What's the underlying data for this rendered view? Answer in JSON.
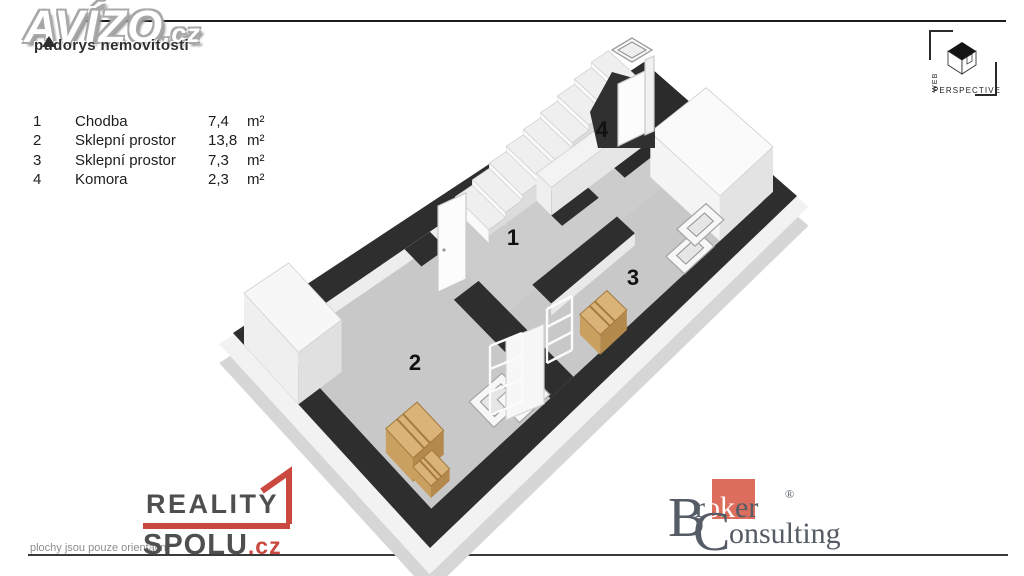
{
  "header": {
    "brand": "AVÍZO",
    "brand_tld": ".cz",
    "subtitle": "půdorys nemovitosti"
  },
  "legend": {
    "rows": [
      {
        "num": "1",
        "name": "Chodba",
        "area": "7,4",
        "unit": "m²"
      },
      {
        "num": "2",
        "name": "Sklepní prostor",
        "area": "13,8",
        "unit": "m²"
      },
      {
        "num": "3",
        "name": "Sklepní prostor",
        "area": "7,3",
        "unit": "m²"
      },
      {
        "num": "4",
        "name": "Komora",
        "area": "2,3",
        "unit": "m²"
      }
    ]
  },
  "watermarks": {
    "web_perspective": {
      "word1": "WEB",
      "word2": "PERSPECTIVE"
    },
    "reality_spolu": {
      "word1": "REALITY",
      "word2": "SPOLU",
      "tld": ".cz",
      "note": "plochy jsou pouze orientační",
      "accent": "#c9483f",
      "text": "#4f4f4f"
    },
    "broker": {
      "cap1": "B",
      "rest1_pre": "r",
      "rest1_mid": "ok",
      "rest1_post": "er",
      "reg": "®",
      "cap2": "C",
      "rest2": "onsulting",
      "accent": "#dd6e5e",
      "text": "#555c66"
    }
  },
  "plan": {
    "uv": [
      880,
      500
    ],
    "corners": {
      "A": [
        233,
        333
      ],
      "N": [
        644,
        62
      ],
      "S": [
        430,
        548
      ],
      "E": [
        797,
        196
      ]
    },
    "wall_color": "#2e2e2e",
    "floor_color": "#c8c8c8",
    "elements": [
      {
        "t": "quad",
        "r": [
          -16,
          -16,
          896,
          516
        ],
        "dy": 32,
        "fill": "#d6d6d6",
        "name": "base-slab-side"
      },
      {
        "t": "quad",
        "r": [
          -16,
          -16,
          896,
          516
        ],
        "dy": 13,
        "fill": "#f2f2f2",
        "name": "base-slab-top"
      },
      {
        "t": "rect",
        "r": [
          48,
          48,
          832,
          452
        ],
        "dy": 6,
        "fill": "#c8c8c8",
        "name": "floor"
      },
      {
        "t": "rect",
        "r": [
          385,
          48,
          832,
          260
        ],
        "dy": 6,
        "fill": "#cccccc",
        "name": "floor-room-1"
      },
      {
        "t": "strip",
        "e": [
          [
            48,
            48
          ],
          [
            832,
            48
          ]
        ],
        "dy": 16,
        "fill": "#ededed",
        "name": "wall-inner-face"
      },
      {
        "t": "strip",
        "e": [
          [
            832,
            48
          ],
          [
            832,
            452
          ]
        ],
        "dy": 16,
        "fill": "#f6f6f6",
        "name": "wall-inner-face"
      },
      {
        "t": "strip",
        "e": [
          [
            48,
            48
          ],
          [
            48,
            452
          ]
        ],
        "dy": 14,
        "fill": "#f1f1f1",
        "name": "wall-inner-face"
      },
      {
        "t": "strip",
        "e": [
          [
            385,
            185
          ],
          [
            385,
            455
          ]
        ],
        "dy": 12,
        "fill": "#e9e9e9",
        "name": "wall-inner-face"
      },
      {
        "t": "strip",
        "e": [
          [
            448,
            312
          ],
          [
            640,
            312
          ]
        ],
        "dy": 12,
        "fill": "#e9e9e9",
        "name": "wall-inner-face"
      },
      {
        "t": "ring",
        "outer": [
          0,
          0,
          880,
          500
        ],
        "inner": [
          48,
          48,
          832,
          452
        ],
        "fill": "#2e2e2e",
        "name": "outer-walls"
      },
      {
        "t": "rect",
        "r": [
          330,
          185,
          385,
          452
        ],
        "fill": "#2e2e2e",
        "name": "wall"
      },
      {
        "t": "rect",
        "r": [
          330,
          48,
          385,
          95
        ],
        "fill": "#2e2e2e",
        "name": "wall"
      },
      {
        "t": "rect",
        "r": [
          448,
          258,
          640,
          312
        ],
        "fill": "#2e2e2e",
        "name": "wall"
      },
      {
        "t": "rect",
        "r": [
          560,
          120,
          642,
          200
        ],
        "fill": "#2e2e2e",
        "name": "wall"
      },
      {
        "t": "rect",
        "r": [
          700,
          28,
          880,
          200
        ],
        "fill": "#2b2b2b",
        "name": "room-4-floor"
      },
      {
        "t": "block",
        "r": [
          732,
          235,
          858,
          452
        ],
        "h": 45,
        "w": "#f4f4f4",
        "s": "#e3e3e3",
        "top": "#fafafa",
        "name": "chimney-block"
      },
      {
        "t": "window",
        "r": [
          648,
          396,
          718,
          452
        ],
        "name": "window-frame"
      },
      {
        "t": "window",
        "r": [
          696,
          366,
          764,
          422
        ],
        "name": "window-frame"
      },
      {
        "t": "window",
        "r": [
          224,
          354,
          300,
          420
        ],
        "name": "window-frame"
      },
      {
        "t": "window",
        "r": [
          262,
          386,
          334,
          446
        ],
        "name": "window-frame"
      },
      {
        "t": "block",
        "r": [
          0,
          28,
          96,
          166
        ],
        "h": 52,
        "w": "#efefef",
        "s": "#e0e0e0",
        "top": "#f7f7f7",
        "name": "chimney-block"
      },
      {
        "t": "stairs",
        "u0": 455,
        "u1": 785,
        "v0": 28,
        "v1": 124,
        "n": 9,
        "rise": 5.3,
        "name": "staircase"
      },
      {
        "t": "block",
        "r": [
          560,
          124,
          785,
          168
        ],
        "h": 28,
        "w": "#efefef",
        "s": "#e6e6e6",
        "top": "#f3f3f3",
        "name": "stair-side-wall"
      },
      {
        "t": "crate",
        "r": [
          445,
          398,
          508,
          456
        ],
        "h": 20,
        "name": "wooden-crate"
      },
      {
        "t": "crate",
        "r": [
          56,
          326,
          128,
          396
        ],
        "h": 24,
        "name": "wooden-crate"
      },
      {
        "t": "crate",
        "r": [
          60,
          392,
          104,
          438
        ],
        "h": 12,
        "name": "wooden-crate"
      }
    ],
    "screen_shapes": [
      {
        "t": "poly",
        "pts": [
          [
            590,
            112
          ],
          [
            612,
            72
          ],
          [
            655,
            84
          ],
          [
            655,
            148
          ],
          [
            598,
            148
          ]
        ],
        "fill": "#303030",
        "name": "room-4-shadow"
      },
      {
        "t": "poly",
        "pts": [
          [
            506,
            420
          ],
          [
            506,
            340
          ],
          [
            544,
            324
          ],
          [
            544,
            404
          ]
        ],
        "fill": "#f7f7f7",
        "stroke": "#d2d2d2",
        "name": "leaning-panel"
      },
      {
        "t": "rack",
        "x": 489,
        "y": 333,
        "w": 34,
        "h": 82,
        "name": "shelf-rack"
      },
      {
        "t": "rack",
        "x": 546,
        "y": 296,
        "w": 27,
        "h": 67,
        "name": "shelf-rack"
      },
      {
        "t": "poly",
        "pts": [
          [
            438,
            292
          ],
          [
            438,
            206
          ],
          [
            466,
            193
          ],
          [
            466,
            279
          ]
        ],
        "fill": "#fcfcfc",
        "stroke": "#c9c9c9",
        "name": "door-leaf"
      },
      {
        "t": "dot",
        "x": 444,
        "y": 250,
        "name": "door-handle"
      },
      {
        "t": "poly",
        "pts": [
          [
            618,
            146
          ],
          [
            618,
            84
          ],
          [
            645,
            71
          ],
          [
            645,
            133
          ]
        ],
        "fill": "#fcfcfc",
        "stroke": "#c9c9c9",
        "name": "door-leaf"
      },
      {
        "t": "poly",
        "pts": [
          [
            645,
            135
          ],
          [
            645,
            60
          ],
          [
            654,
            56
          ],
          [
            654,
            131
          ]
        ],
        "fill": "#f1f1f1",
        "stroke": "#cccccc",
        "name": "door-post"
      },
      {
        "t": "frame",
        "o": [
          [
            612,
            50
          ],
          [
            632,
            38
          ],
          [
            652,
            50
          ],
          [
            632,
            62
          ]
        ],
        "i": [
          [
            618,
            50
          ],
          [
            632,
            42
          ],
          [
            646,
            50
          ],
          [
            632,
            58
          ]
        ],
        "name": "transom-window"
      }
    ],
    "labels": [
      {
        "text": "1",
        "x": 513,
        "y": 245
      },
      {
        "text": "2",
        "x": 415,
        "y": 370
      },
      {
        "text": "3",
        "x": 633,
        "y": 285
      },
      {
        "text": "4",
        "x": 602,
        "y": 137
      }
    ]
  }
}
